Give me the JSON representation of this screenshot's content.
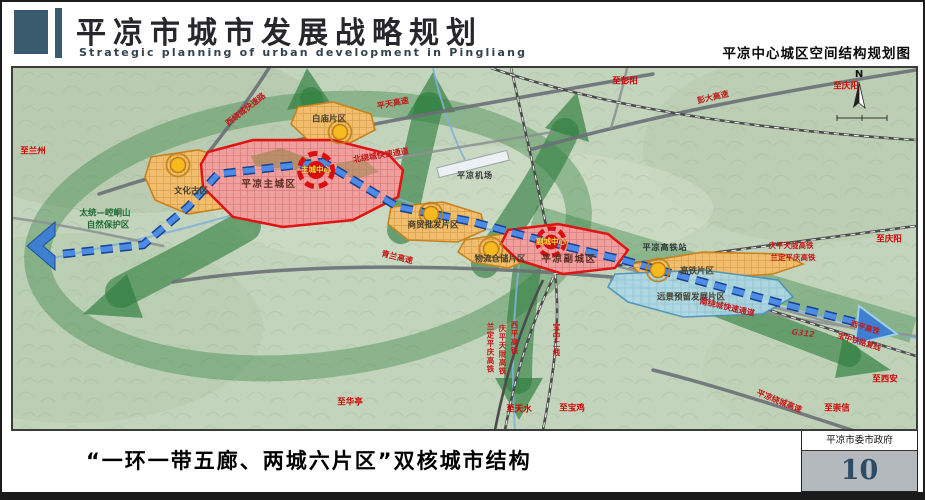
{
  "header": {
    "title_cn": "平凉市城市发展战略规划",
    "title_en": "Strategic planning of urban development in Pingliang",
    "map_title": "平凉中心城区空间结构规划图"
  },
  "footer": {
    "caption": "“一环一带五廊、两城六片区”双核城市结构",
    "authority": "平凉市委市政府",
    "page_number": "10"
  },
  "map": {
    "legend_concept": "一环一带五廊、两城六片区",
    "labels": [
      {
        "text": "至兰州",
        "x": 20,
        "y": 84,
        "cls": "dest"
      },
      {
        "text": "西绕城快速路",
        "x": 233,
        "y": 42,
        "cls": "road",
        "rot": -38
      },
      {
        "text": "平天高速",
        "x": 380,
        "y": 36,
        "cls": "road",
        "rot": -11
      },
      {
        "text": "至彭阳",
        "x": 612,
        "y": 14,
        "cls": "dest"
      },
      {
        "text": "彭大高速",
        "x": 700,
        "y": 30,
        "cls": "road",
        "rot": -13
      },
      {
        "text": "至庆阳",
        "x": 833,
        "y": 19,
        "cls": "dest"
      },
      {
        "text": "白庙片区",
        "x": 316,
        "y": 52,
        "cls": "area"
      },
      {
        "text": "北绕城快速通道",
        "x": 368,
        "y": 88,
        "cls": "road",
        "rot": -9
      },
      {
        "text": "平凉机场",
        "x": 462,
        "y": 108,
        "cls": "poi"
      },
      {
        "text": "平凉主城区",
        "x": 256,
        "y": 117,
        "cls": "city"
      },
      {
        "text": "主城中心",
        "x": 303,
        "y": 102,
        "cls": "center"
      },
      {
        "text": "文化古区",
        "x": 178,
        "y": 124,
        "cls": "area"
      },
      {
        "text": "太统—崆峒山",
        "x": 92,
        "y": 146,
        "cls": "nature"
      },
      {
        "text": "自然保护区",
        "x": 95,
        "y": 158,
        "cls": "nature"
      },
      {
        "text": "青兰高速",
        "x": 384,
        "y": 190,
        "cls": "road",
        "rot": 14
      },
      {
        "text": "商贸批发片区",
        "x": 420,
        "y": 158,
        "cls": "area"
      },
      {
        "text": "物流仓储片区",
        "x": 487,
        "y": 192,
        "cls": "area"
      },
      {
        "text": "副城中心",
        "x": 538,
        "y": 174,
        "cls": "center"
      },
      {
        "text": "平凉副城区",
        "x": 556,
        "y": 192,
        "cls": "city"
      },
      {
        "text": "平凉高铁站",
        "x": 652,
        "y": 180,
        "cls": "poi"
      },
      {
        "text": "庆平天陇高铁",
        "x": 778,
        "y": 178,
        "cls": "rail"
      },
      {
        "text": "兰定平庆高铁",
        "x": 780,
        "y": 190,
        "cls": "rail"
      },
      {
        "text": "至庆阳",
        "x": 876,
        "y": 172,
        "cls": "dest"
      },
      {
        "text": "高铁片区",
        "x": 684,
        "y": 204,
        "cls": "area"
      },
      {
        "text": "远景预留发展片区",
        "x": 678,
        "y": 230,
        "cls": "area"
      },
      {
        "text": "南绕城快速通道",
        "x": 714,
        "y": 240,
        "cls": "road",
        "rot": 13
      },
      {
        "text": "G312",
        "x": 790,
        "y": 266,
        "cls": "routenum",
        "rot": 7
      },
      {
        "text": "西平高铁",
        "x": 852,
        "y": 260,
        "cls": "rail",
        "rot": 17
      },
      {
        "text": "宝中铁路复线",
        "x": 846,
        "y": 274,
        "cls": "rail",
        "rot": 17
      },
      {
        "text": "至西安",
        "x": 872,
        "y": 312,
        "cls": "dest"
      },
      {
        "text": "平凉绕城高速",
        "x": 766,
        "y": 334,
        "cls": "road",
        "rot": 22
      },
      {
        "text": "至崇信",
        "x": 824,
        "y": 341,
        "cls": "dest"
      },
      {
        "text": "兰定平庆高铁",
        "x": 477,
        "y": 280,
        "cls": "rail",
        "vert": true
      },
      {
        "text": "庆平天陇高铁",
        "x": 489,
        "y": 282,
        "cls": "rail",
        "vert": true
      },
      {
        "text": "西平高铁",
        "x": 501,
        "y": 270,
        "cls": "rail",
        "vert": true
      },
      {
        "text": "宝中二线",
        "x": 543,
        "y": 272,
        "cls": "rail",
        "vert": true
      },
      {
        "text": "至华亭",
        "x": 337,
        "y": 335,
        "cls": "dest"
      },
      {
        "text": "至天水",
        "x": 506,
        "y": 342,
        "cls": "dest"
      },
      {
        "text": "至宝鸡",
        "x": 559,
        "y": 341,
        "cls": "dest"
      },
      {
        "text": "N",
        "x": 846,
        "y": 7,
        "cls": "compass"
      }
    ]
  }
}
